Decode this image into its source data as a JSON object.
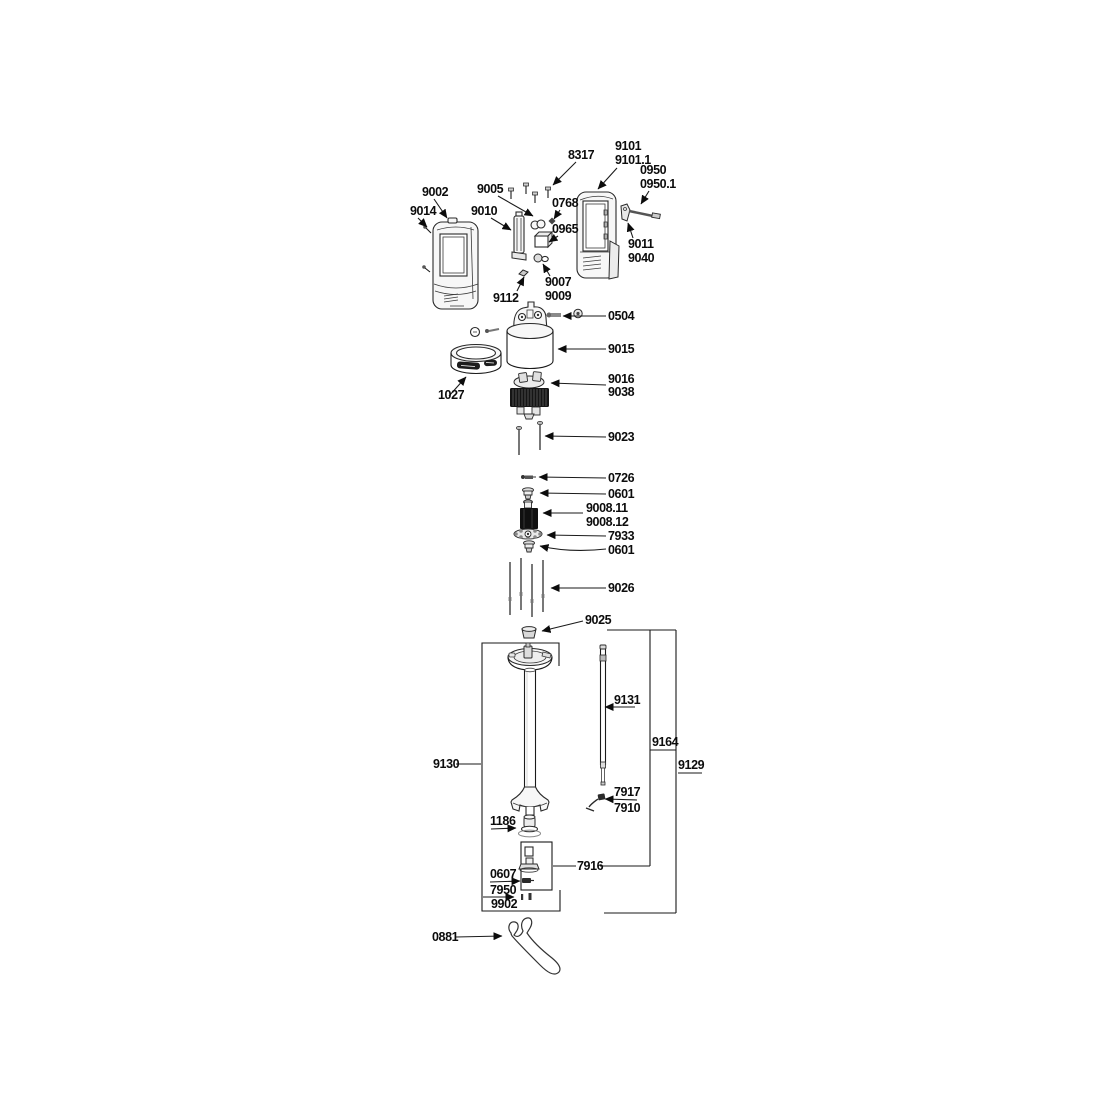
{
  "diagram": {
    "type": "exploded-parts-diagram",
    "colors": {
      "ink": "#1a1a1a",
      "paper": "#ffffff",
      "dark_part_fill": "#141414"
    },
    "labels": {
      "p8317": "8317",
      "p9101": "9101",
      "p9101_1": "9101.1",
      "p0950": "0950",
      "p0950_1": "0950.1",
      "p9002": "9002",
      "p9014": "9014",
      "p9005": "9005",
      "p9010": "9010",
      "p0768": "0768",
      "p0965": "0965",
      "p9011": "9011",
      "p9040": "9040",
      "p9112": "9112",
      "p9007": "9007",
      "p9009": "9009",
      "p0504": "0504",
      "p9015": "9015",
      "p1027": "1027",
      "p9016": "9016",
      "p9038": "9038",
      "p9023": "9023",
      "p0726": "0726",
      "p0601a": "0601",
      "p9008_11": "9008.11",
      "p9008_12": "9008.12",
      "p7933": "7933",
      "p0601b": "0601",
      "p9026": "9026",
      "p9025": "9025",
      "p9130": "9130",
      "p9131": "9131",
      "p9164": "9164",
      "p9129": "9129",
      "p7917": "7917",
      "p7910": "7910",
      "p1186": "1186",
      "p7916": "7916",
      "p0607": "0607",
      "p7950": "7950",
      "p9902": "9902",
      "p0881": "0881"
    }
  }
}
